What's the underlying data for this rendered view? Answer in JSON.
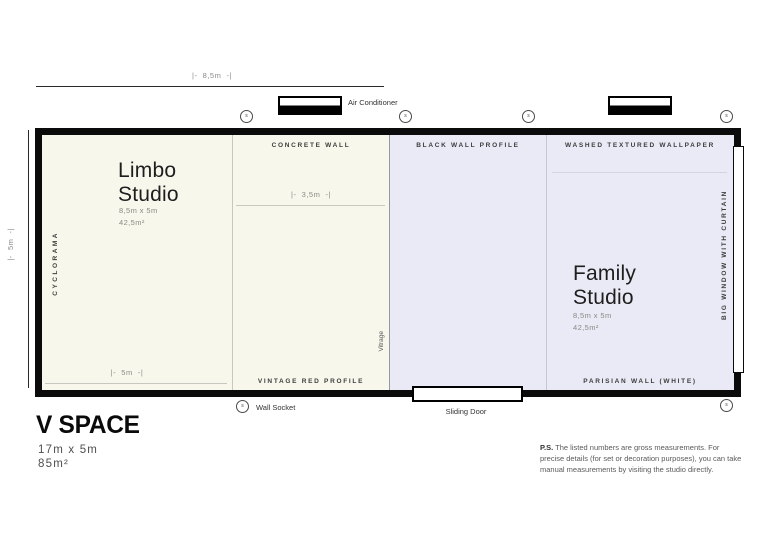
{
  "title_block": {
    "name": "V SPACE",
    "dimensions": "17m x 5m",
    "area": "85m²"
  },
  "note": {
    "label": "P.S.",
    "text": " The listed numbers are gross measurements. For precise details (for set or decoration purposes), you can take manual measurements by visiting the studio directly."
  },
  "dimensions": {
    "top_width": "|-  8,5m  -|",
    "left_height": "|-  5m  -|",
    "cyclorama_width": "|-  5m  -|",
    "concrete_width": "|-  3,5m  -|"
  },
  "rooms": {
    "limbo": {
      "name": "Limbo\nStudio",
      "size": "8,5m x 5m\n42,5m²"
    },
    "family": {
      "name": "Family\nStudio",
      "size": "8,5m x 5m\n42,5m²"
    }
  },
  "wall_labels": {
    "cyclorama": "CYCLORAMA",
    "concrete_wall": "CONCRETE WALL",
    "vintage_red_profile": "VINTAGE RED PROFILE",
    "black_wall_profile": "BLACK WALL PROFILE",
    "washed_textured_wallpaper": "WASHED TEXTURED WALLPAPER",
    "parisian_wall": "PARISIAN WALL (WHITE)",
    "big_window": "BIG WINDOW WITH CURTAIN",
    "vitrage": "Vitrage"
  },
  "legend": {
    "air_conditioner": "Air Conditioner",
    "wall_socket": "Wall Socket",
    "sliding_door": "Sliding Door",
    "socket_symbol": "s"
  },
  "colors": {
    "limbo_bg": "#f8f7ec",
    "family_bg": "#e9eaf5",
    "wall": "#0b0b0b"
  }
}
